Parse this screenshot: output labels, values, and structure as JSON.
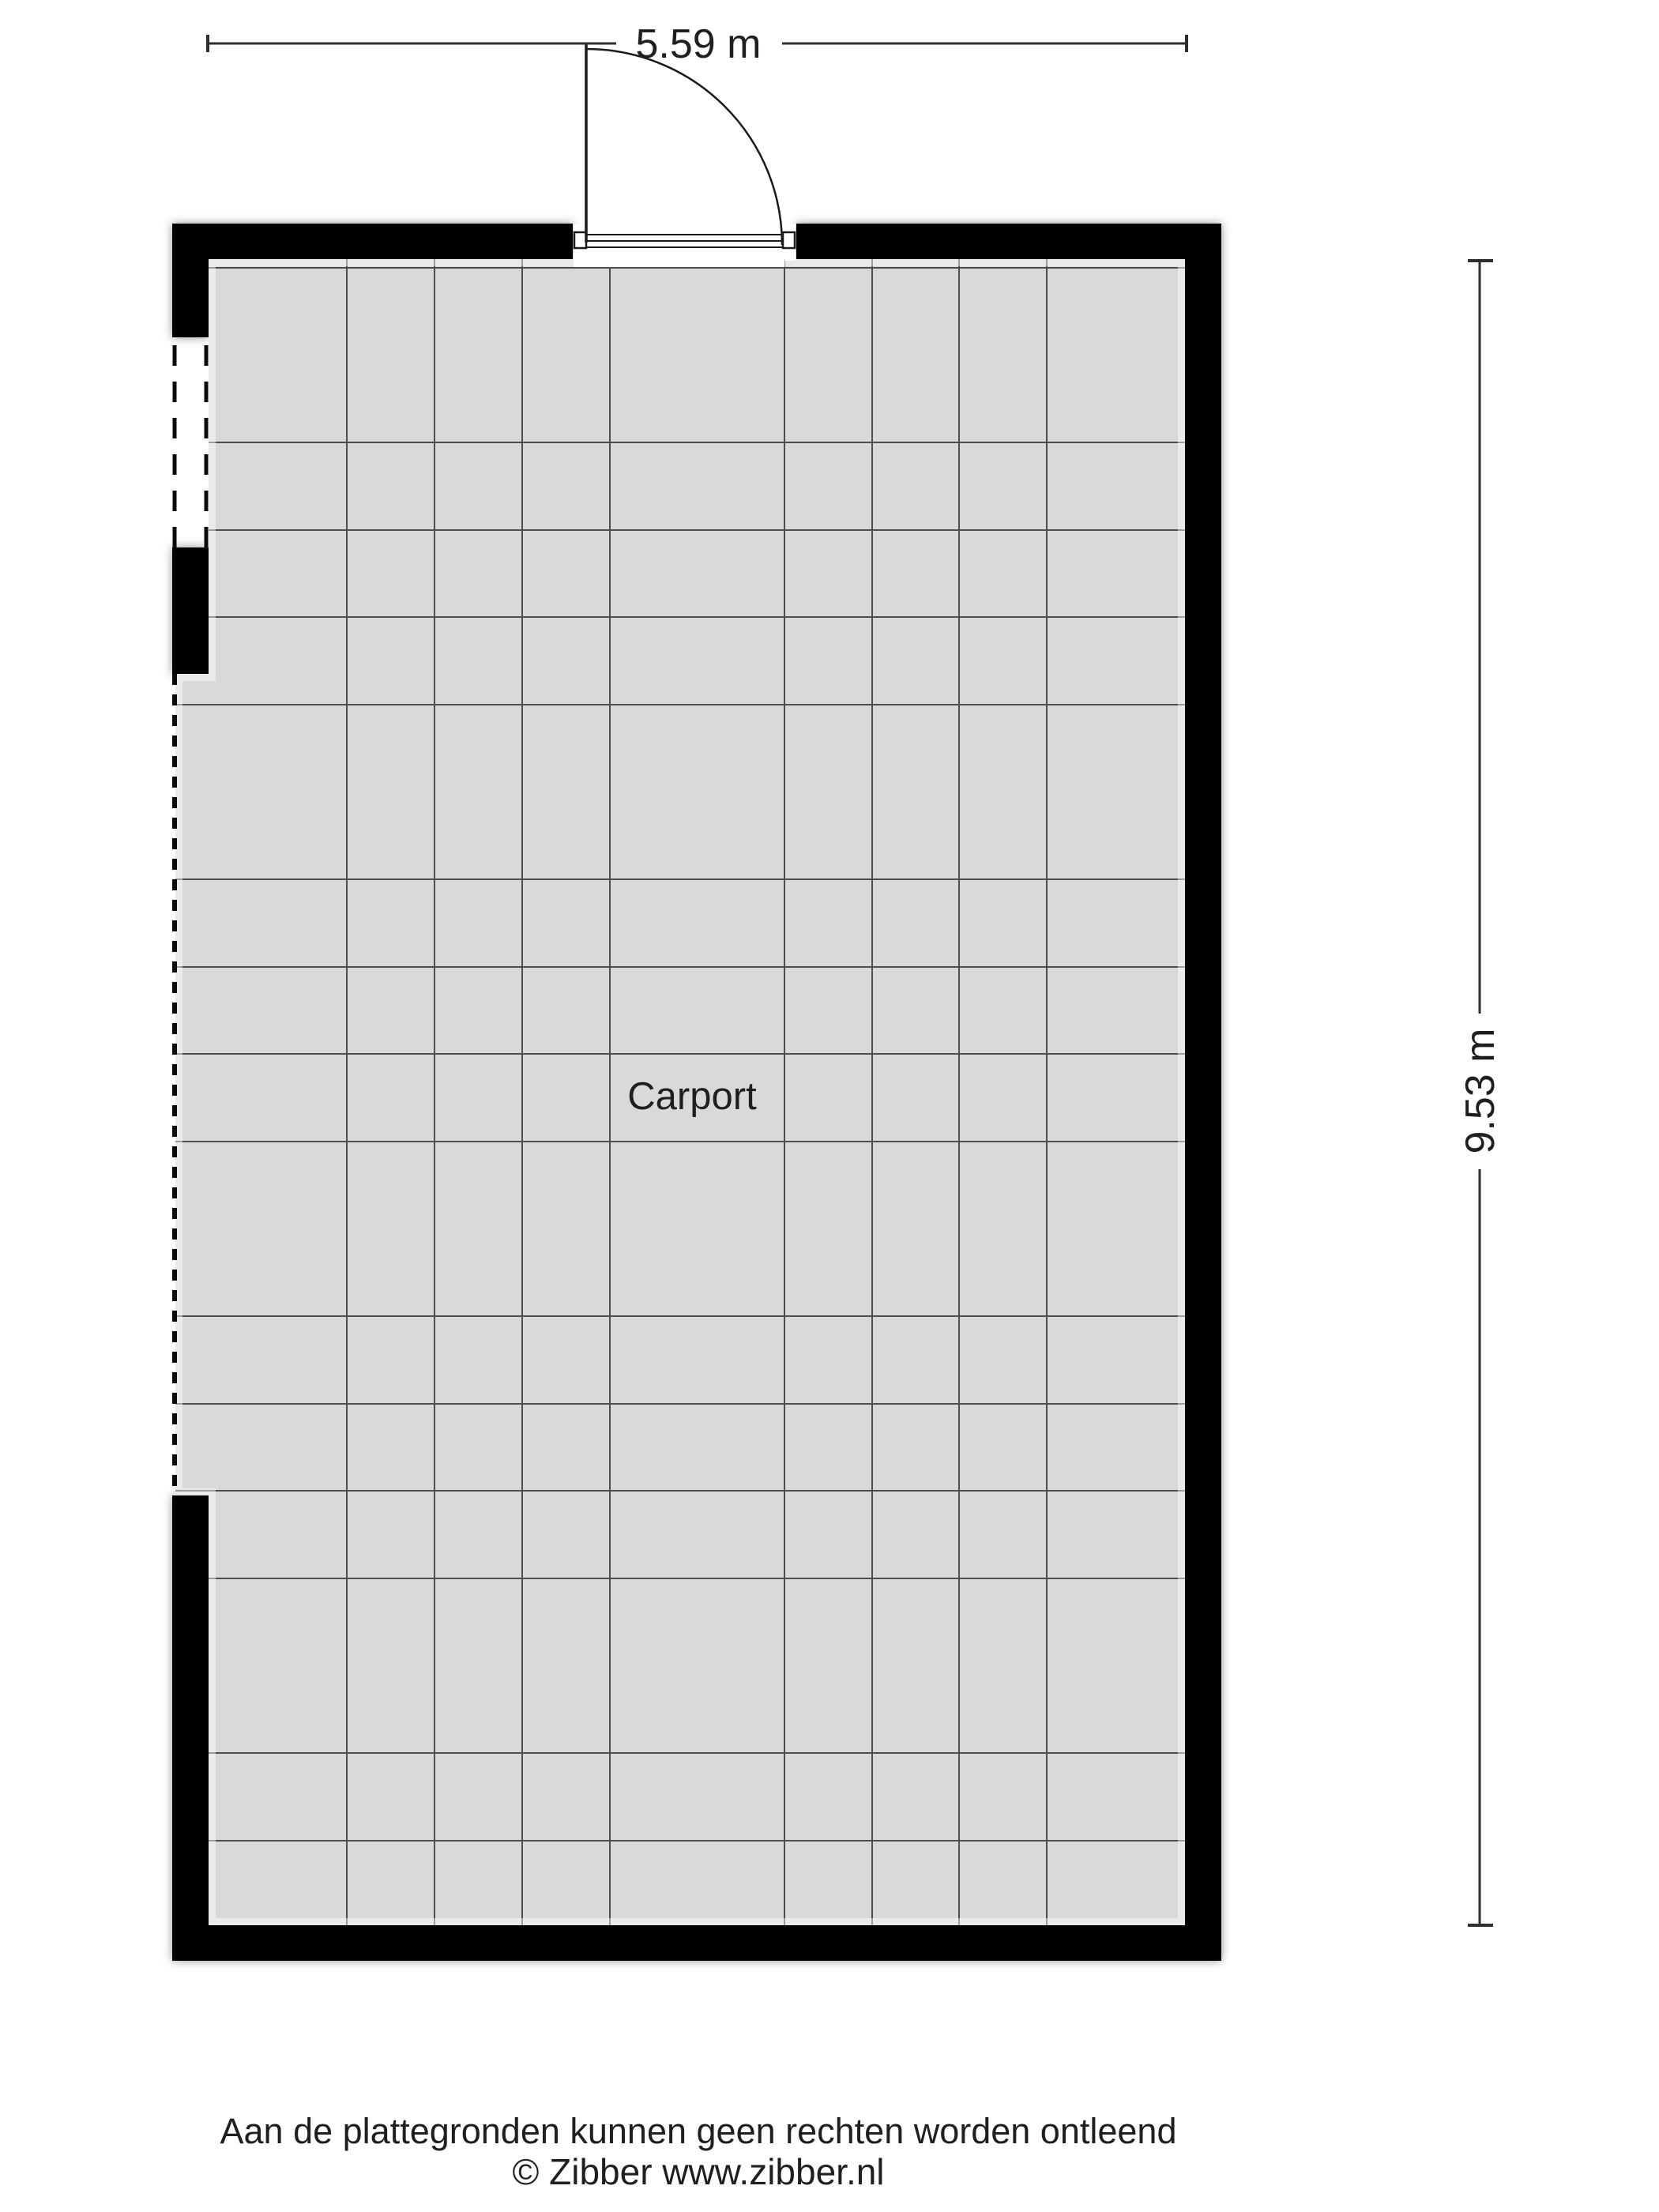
{
  "room": {
    "label": "Carport"
  },
  "dimensions": {
    "width_label": "5.59 m",
    "height_label": "9.53 m"
  },
  "footer": {
    "disclaimer": "Aan de plattegronden kunnen geen rechten worden ontleend",
    "copyright": "© Zibber www.zibber.nl"
  },
  "colors": {
    "wall": "#000000",
    "floor": "#d9d9d9",
    "grid_line": "#4d4d4d",
    "dash_line": "#0a0a0a",
    "dimension_line": "#2e2e2e",
    "text": "#1f1f1f",
    "door_line": "#1a1a1a"
  }
}
